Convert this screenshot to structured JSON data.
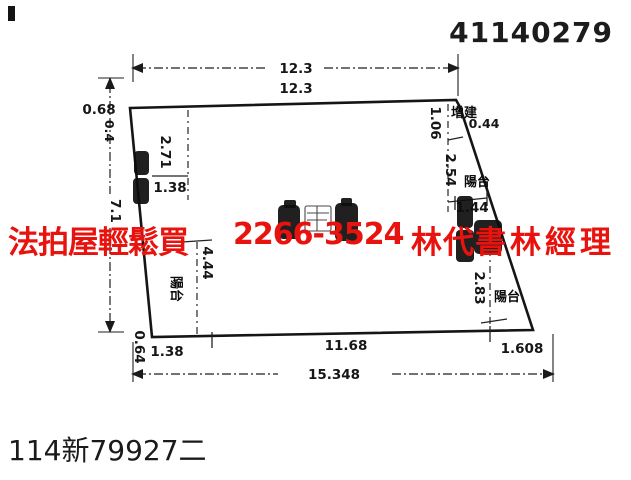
{
  "header": {
    "doc_number": "41140279"
  },
  "watermark": {
    "color": "#e8130e",
    "seg1": "法拍屋輕鬆買",
    "seg2": "2266-3524",
    "seg3": "林代書",
    "seg4": "林經理"
  },
  "plan": {
    "dims": {
      "top_overall": "12.3",
      "top_edge": "12.3",
      "top_left_offset": "0.68",
      "left_step": "0.4",
      "left_overall": "7.1",
      "inner_left_depth": "2.71",
      "inner_left_width": "1.38",
      "balcony_left_depth": "4.44",
      "bottom_left_offset": "0.64",
      "bottom_left": "1.38",
      "bottom_middle": "11.68",
      "bottom_right": "1.608",
      "bottom_overall": "15.348",
      "right_top": "1.06",
      "right_upper": "2.54",
      "right_top_width": "0.44",
      "right_mid_width": "1.44",
      "right_lower": "2.83"
    },
    "labels": {
      "annex": "增建",
      "balcony": "陽台"
    }
  },
  "footer": {
    "case_number": "114新79927二"
  }
}
